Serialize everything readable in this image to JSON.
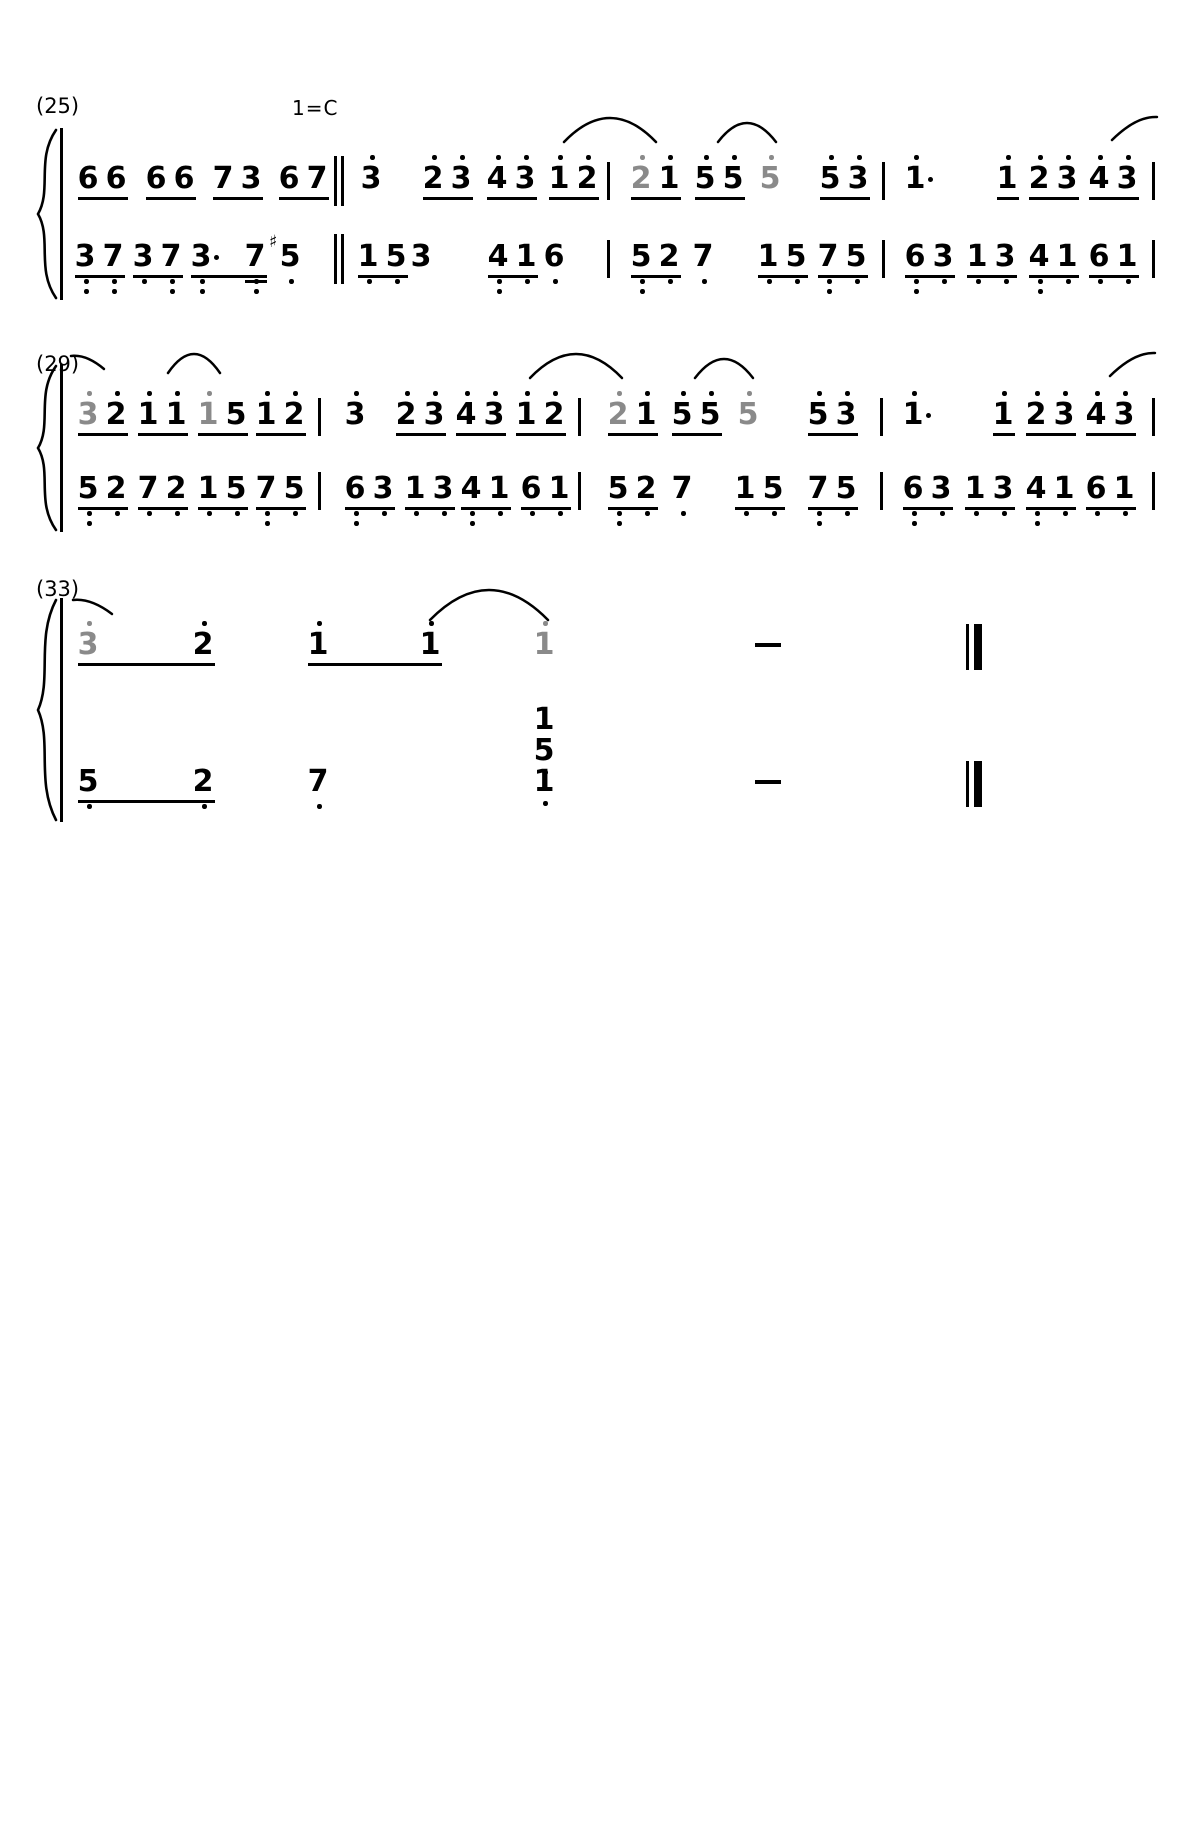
{
  "page": {
    "width": 1200,
    "height": 1845,
    "paper": "#ffffff",
    "ink": "#000000",
    "gray_note": "#8a8a8a"
  },
  "notation": {
    "style": "jianpu-numbered-score",
    "key_label": "1=C"
  },
  "systems": [
    {
      "label": "(25)",
      "label_x": 36,
      "label_y": 94,
      "key": "1=C",
      "key_x": 292,
      "key_y": 96,
      "treble_y": 164,
      "bass_y": 242,
      "brace": {
        "y1": 128,
        "y2": 300
      },
      "treble": [
        {
          "t": "g",
          "x": 80,
          "notes": [
            {
              "d": "6"
            },
            {
              "d": "6"
            }
          ]
        },
        {
          "t": "g",
          "x": 148,
          "notes": [
            {
              "d": "6"
            },
            {
              "d": "6"
            }
          ]
        },
        {
          "t": "g",
          "x": 215,
          "notes": [
            {
              "d": "7"
            },
            {
              "d": "3"
            }
          ]
        },
        {
          "t": "g",
          "x": 281,
          "notes": [
            {
              "d": "6"
            },
            {
              "d": "7"
            }
          ]
        },
        {
          "t": "dbar",
          "x": 334
        },
        {
          "t": "n",
          "x": 363,
          "notes": [
            {
              "d": "3",
              "hi": 1
            }
          ]
        },
        {
          "t": "g",
          "x": 425,
          "notes": [
            {
              "d": "2",
              "hi": 1
            },
            {
              "d": "3",
              "hi": 1
            }
          ]
        },
        {
          "t": "g",
          "x": 489,
          "notes": [
            {
              "d": "4",
              "hi": 1
            },
            {
              "d": "3",
              "hi": 1
            }
          ]
        },
        {
          "t": "g",
          "x": 551,
          "notes": [
            {
              "d": "1",
              "hi": 1
            },
            {
              "d": "2",
              "hi": 1
            }
          ]
        },
        {
          "t": "bar",
          "x": 607
        },
        {
          "t": "g",
          "x": 633,
          "notes": [
            {
              "d": "2",
              "hi": 1,
              "gray": true
            },
            {
              "d": "1",
              "hi": 1
            }
          ]
        },
        {
          "t": "g",
          "x": 697,
          "notes": [
            {
              "d": "5",
              "hi": 1
            },
            {
              "d": "5",
              "hi": 1
            }
          ]
        },
        {
          "t": "n",
          "x": 762,
          "notes": [
            {
              "d": "5",
              "hi": 1,
              "gray": true
            }
          ]
        },
        {
          "t": "g",
          "x": 822,
          "notes": [
            {
              "d": "5",
              "hi": 1
            },
            {
              "d": "3",
              "hi": 1
            }
          ]
        },
        {
          "t": "bar",
          "x": 882
        },
        {
          "t": "n",
          "x": 907,
          "notes": [
            {
              "d": "1",
              "hi": 1,
              "aug": true
            }
          ]
        },
        {
          "t": "g",
          "x": 999,
          "notes": [
            {
              "d": "1",
              "hi": 1
            }
          ]
        },
        {
          "t": "g",
          "x": 1031,
          "notes": [
            {
              "d": "2",
              "hi": 1
            },
            {
              "d": "3",
              "hi": 1
            }
          ]
        },
        {
          "t": "g",
          "x": 1091,
          "notes": [
            {
              "d": "4",
              "hi": 1
            },
            {
              "d": "3",
              "hi": 1
            }
          ]
        },
        {
          "t": "bar",
          "x": 1152
        }
      ],
      "bass": [
        {
          "t": "g",
          "x": 77,
          "notes": [
            {
              "d": "3",
              "lo": 2
            },
            {
              "d": "7",
              "lo": 2
            }
          ]
        },
        {
          "t": "g",
          "x": 135,
          "notes": [
            {
              "d": "3",
              "lo": 1
            },
            {
              "d": "7",
              "lo": 2
            }
          ]
        },
        {
          "t": "g",
          "x": 193,
          "sp": [
            0,
            54
          ],
          "ulw": 76,
          "notes": [
            {
              "d": "3",
              "lo": 2,
              "aug": true
            },
            {
              "d": "7",
              "lo": 2,
              "dbl": true
            }
          ]
        },
        {
          "t": "n",
          "x": 282,
          "notes": [
            {
              "d": "5",
              "lo": 1,
              "sharp": true
            }
          ]
        },
        {
          "t": "dbar",
          "x": 334
        },
        {
          "t": "g",
          "x": 360,
          "notes": [
            {
              "d": "1",
              "lo": 1
            },
            {
              "d": "5",
              "lo": 1
            }
          ]
        },
        {
          "t": "n",
          "x": 413,
          "notes": [
            {
              "d": "3"
            }
          ]
        },
        {
          "t": "g",
          "x": 490,
          "notes": [
            {
              "d": "4",
              "lo": 2
            },
            {
              "d": "1",
              "lo": 1
            }
          ]
        },
        {
          "t": "n",
          "x": 546,
          "notes": [
            {
              "d": "6",
              "lo": 1
            }
          ]
        },
        {
          "t": "bar",
          "x": 607
        },
        {
          "t": "g",
          "x": 633,
          "notes": [
            {
              "d": "5",
              "lo": 2
            },
            {
              "d": "2",
              "lo": 1
            }
          ]
        },
        {
          "t": "n",
          "x": 695,
          "notes": [
            {
              "d": "7",
              "lo": 1
            }
          ]
        },
        {
          "t": "g",
          "x": 760,
          "notes": [
            {
              "d": "1",
              "lo": 1
            },
            {
              "d": "5",
              "lo": 1
            }
          ]
        },
        {
          "t": "g",
          "x": 820,
          "notes": [
            {
              "d": "7",
              "lo": 2
            },
            {
              "d": "5",
              "lo": 1
            }
          ]
        },
        {
          "t": "bar",
          "x": 882
        },
        {
          "t": "g",
          "x": 907,
          "notes": [
            {
              "d": "6",
              "lo": 2
            },
            {
              "d": "3",
              "lo": 1
            }
          ]
        },
        {
          "t": "g",
          "x": 969,
          "notes": [
            {
              "d": "1",
              "lo": 1
            },
            {
              "d": "3",
              "lo": 1
            }
          ]
        },
        {
          "t": "g",
          "x": 1031,
          "notes": [
            {
              "d": "4",
              "lo": 2
            },
            {
              "d": "1",
              "lo": 1
            }
          ]
        },
        {
          "t": "g",
          "x": 1091,
          "notes": [
            {
              "d": "6",
              "lo": 1
            },
            {
              "d": "1",
              "lo": 1
            }
          ]
        },
        {
          "t": "bar",
          "x": 1152
        }
      ],
      "slurs": [
        {
          "x": 562,
          "y": 116,
          "w": 96,
          "h": 28,
          "kind": "full"
        },
        {
          "x": 716,
          "y": 121,
          "w": 62,
          "h": 23,
          "kind": "full"
        },
        {
          "x": 1110,
          "y": 114,
          "w": 48,
          "h": 28,
          "kind": "left"
        }
      ]
    },
    {
      "label": "(29)",
      "label_x": 36,
      "label_y": 352,
      "treble_y": 400,
      "bass_y": 474,
      "brace": {
        "y1": 364,
        "y2": 532
      },
      "treble": [
        {
          "t": "g",
          "x": 80,
          "notes": [
            {
              "d": "3",
              "hi": 1,
              "gray": true
            },
            {
              "d": "2",
              "hi": 1
            }
          ]
        },
        {
          "t": "g",
          "x": 140,
          "notes": [
            {
              "d": "1",
              "hi": 1
            },
            {
              "d": "1",
              "hi": 1
            }
          ]
        },
        {
          "t": "g",
          "x": 200,
          "notes": [
            {
              "d": "1",
              "hi": 1,
              "gray": true
            },
            {
              "d": "5"
            }
          ]
        },
        {
          "t": "g",
          "x": 258,
          "notes": [
            {
              "d": "1",
              "hi": 1
            },
            {
              "d": "2",
              "hi": 1
            }
          ]
        },
        {
          "t": "bar",
          "x": 318
        },
        {
          "t": "n",
          "x": 347,
          "notes": [
            {
              "d": "3",
              "hi": 1
            }
          ]
        },
        {
          "t": "g",
          "x": 398,
          "notes": [
            {
              "d": "2",
              "hi": 1
            },
            {
              "d": "3",
              "hi": 1
            }
          ]
        },
        {
          "t": "g",
          "x": 458,
          "notes": [
            {
              "d": "4",
              "hi": 1
            },
            {
              "d": "3",
              "hi": 1
            }
          ]
        },
        {
          "t": "g",
          "x": 518,
          "notes": [
            {
              "d": "1",
              "hi": 1
            },
            {
              "d": "2",
              "hi": 1
            }
          ]
        },
        {
          "t": "bar",
          "x": 578
        },
        {
          "t": "g",
          "x": 610,
          "notes": [
            {
              "d": "2",
              "hi": 1,
              "gray": true
            },
            {
              "d": "1",
              "hi": 1
            }
          ]
        },
        {
          "t": "g",
          "x": 674,
          "notes": [
            {
              "d": "5",
              "hi": 1
            },
            {
              "d": "5",
              "hi": 1
            }
          ]
        },
        {
          "t": "n",
          "x": 740,
          "notes": [
            {
              "d": "5",
              "hi": 1,
              "gray": true
            }
          ]
        },
        {
          "t": "g",
          "x": 810,
          "notes": [
            {
              "d": "5",
              "hi": 1
            },
            {
              "d": "3",
              "hi": 1
            }
          ]
        },
        {
          "t": "bar",
          "x": 880
        },
        {
          "t": "n",
          "x": 905,
          "notes": [
            {
              "d": "1",
              "hi": 1,
              "aug": true
            }
          ]
        },
        {
          "t": "g",
          "x": 995,
          "notes": [
            {
              "d": "1",
              "hi": 1
            }
          ]
        },
        {
          "t": "g",
          "x": 1028,
          "notes": [
            {
              "d": "2",
              "hi": 1
            },
            {
              "d": "3",
              "hi": 1
            }
          ]
        },
        {
          "t": "g",
          "x": 1088,
          "notes": [
            {
              "d": "4",
              "hi": 1
            },
            {
              "d": "3",
              "hi": 1
            }
          ]
        },
        {
          "t": "bar",
          "x": 1152
        }
      ],
      "bass": [
        {
          "t": "g",
          "x": 80,
          "notes": [
            {
              "d": "5",
              "lo": 2
            },
            {
              "d": "2",
              "lo": 1
            }
          ]
        },
        {
          "t": "g",
          "x": 140,
          "notes": [
            {
              "d": "7",
              "lo": 1
            },
            {
              "d": "2",
              "lo": 1
            }
          ]
        },
        {
          "t": "g",
          "x": 200,
          "notes": [
            {
              "d": "1",
              "lo": 1
            },
            {
              "d": "5",
              "lo": 1
            }
          ]
        },
        {
          "t": "g",
          "x": 258,
          "notes": [
            {
              "d": "7",
              "lo": 2
            },
            {
              "d": "5",
              "lo": 1
            }
          ]
        },
        {
          "t": "bar",
          "x": 318
        },
        {
          "t": "g",
          "x": 347,
          "notes": [
            {
              "d": "6",
              "lo": 2
            },
            {
              "d": "3",
              "lo": 1
            }
          ]
        },
        {
          "t": "g",
          "x": 407,
          "notes": [
            {
              "d": "1",
              "lo": 1
            },
            {
              "d": "3",
              "lo": 1
            }
          ]
        },
        {
          "t": "g",
          "x": 463,
          "notes": [
            {
              "d": "4",
              "lo": 2
            },
            {
              "d": "1",
              "lo": 1
            }
          ]
        },
        {
          "t": "g",
          "x": 523,
          "notes": [
            {
              "d": "6",
              "lo": 1
            },
            {
              "d": "1",
              "lo": 1
            }
          ]
        },
        {
          "t": "bar",
          "x": 578
        },
        {
          "t": "g",
          "x": 610,
          "notes": [
            {
              "d": "5",
              "lo": 2
            },
            {
              "d": "2",
              "lo": 1
            }
          ]
        },
        {
          "t": "n",
          "x": 674,
          "notes": [
            {
              "d": "7",
              "lo": 1
            }
          ]
        },
        {
          "t": "g",
          "x": 737,
          "notes": [
            {
              "d": "1",
              "lo": 1
            },
            {
              "d": "5",
              "lo": 1
            }
          ]
        },
        {
          "t": "g",
          "x": 810,
          "notes": [
            {
              "d": "7",
              "lo": 2
            },
            {
              "d": "5",
              "lo": 1
            }
          ]
        },
        {
          "t": "bar",
          "x": 880
        },
        {
          "t": "g",
          "x": 905,
          "notes": [
            {
              "d": "6",
              "lo": 2
            },
            {
              "d": "3",
              "lo": 1
            }
          ]
        },
        {
          "t": "g",
          "x": 967,
          "notes": [
            {
              "d": "1",
              "lo": 1
            },
            {
              "d": "3",
              "lo": 1
            }
          ]
        },
        {
          "t": "g",
          "x": 1028,
          "notes": [
            {
              "d": "4",
              "lo": 2
            },
            {
              "d": "1",
              "lo": 1
            }
          ]
        },
        {
          "t": "g",
          "x": 1088,
          "notes": [
            {
              "d": "6",
              "lo": 1
            },
            {
              "d": "1",
              "lo": 1
            }
          ]
        },
        {
          "t": "bar",
          "x": 1152
        }
      ],
      "slurs": [
        {
          "x": 70,
          "y": 352,
          "w": 36,
          "h": 19,
          "kind": "right"
        },
        {
          "x": 166,
          "y": 352,
          "w": 56,
          "h": 23,
          "kind": "full"
        },
        {
          "x": 528,
          "y": 352,
          "w": 96,
          "h": 28,
          "kind": "full"
        },
        {
          "x": 693,
          "y": 357,
          "w": 62,
          "h": 23,
          "kind": "full"
        },
        {
          "x": 1108,
          "y": 350,
          "w": 48,
          "h": 28,
          "kind": "left"
        }
      ]
    },
    {
      "label": "(33)",
      "label_x": 36,
      "label_y": 577,
      "treble_y": 630,
      "bass_y": 767,
      "brace": {
        "y1": 598,
        "y2": 822
      },
      "treble": [
        {
          "t": "g",
          "x": 80,
          "sp": [
            0,
            115
          ],
          "ulw": 137,
          "notes": [
            {
              "d": "3",
              "hi": 1,
              "gray": true
            },
            {
              "d": "2",
              "hi": 1
            }
          ]
        },
        {
          "t": "g",
          "x": 310,
          "sp": [
            0,
            112
          ],
          "ulw": 134,
          "notes": [
            {
              "d": "1",
              "hi": 1
            },
            {
              "d": "1",
              "hi": 1
            }
          ]
        },
        {
          "t": "n",
          "x": 536,
          "notes": [
            {
              "d": "1",
              "hi": 1,
              "gray": true
            }
          ]
        },
        {
          "t": "dash",
          "x": 755
        },
        {
          "t": "fbar",
          "x": 966
        }
      ],
      "bass": [
        {
          "t": "g",
          "x": 80,
          "sp": [
            0,
            115
          ],
          "ulw": 137,
          "notes": [
            {
              "d": "5",
              "lo": 1
            },
            {
              "d": "2",
              "lo": 1
            }
          ]
        },
        {
          "t": "n",
          "x": 310,
          "notes": [
            {
              "d": "7",
              "lo": 1
            }
          ]
        },
        {
          "t": "chord",
          "x": 536,
          "notes": [
            {
              "d": "1"
            },
            {
              "d": "5",
              "lo": 1
            },
            {
              "d": "1",
              "lo": 1
            }
          ]
        },
        {
          "t": "dash",
          "x": 755
        },
        {
          "t": "fbar",
          "x": 966
        }
      ],
      "slurs": [
        {
          "x": 72,
          "y": 596,
          "w": 42,
          "h": 20,
          "kind": "right"
        },
        {
          "x": 428,
          "y": 588,
          "w": 122,
          "h": 34,
          "kind": "full"
        }
      ]
    }
  ]
}
